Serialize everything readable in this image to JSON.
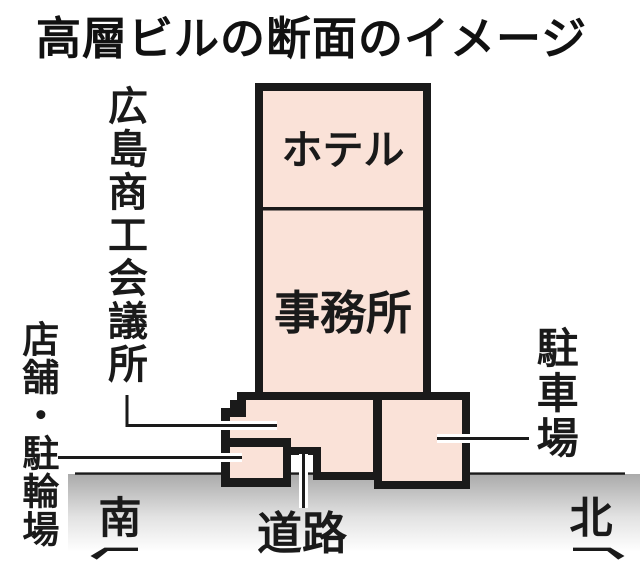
{
  "title": "高層ビルの断面のイメージ",
  "diagram": {
    "building": {
      "hotel_label": "ホテル",
      "office_label": "事務所",
      "chamber_label": "広島商工会議所",
      "shops_label": "店舗・駐輪場",
      "parking_label": "駐車場",
      "road_label": "道路"
    },
    "directions": {
      "south": "南",
      "north": "北"
    },
    "colors": {
      "building_fill": "#fae2d8",
      "outline": "#1a1a1a",
      "ground_top": "#aaaaaa",
      "ground_bottom": "#ffffff"
    }
  }
}
